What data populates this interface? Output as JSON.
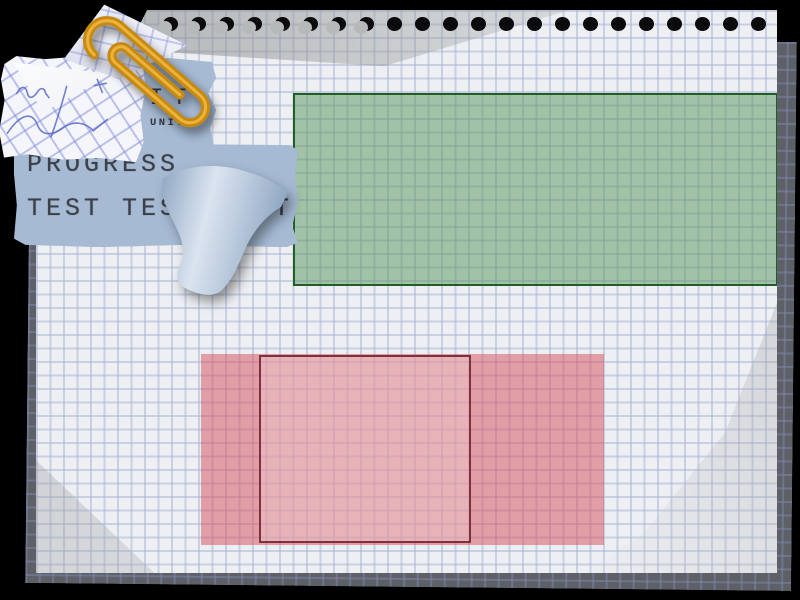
{
  "notebook": {
    "binding_hole_count": 22,
    "torn_hole_count": 8
  },
  "stickers": {
    "unit_label_large": "UNIT A",
    "unit_label_small": "UNIT A",
    "progress_line": "PROGRESS",
    "test_line": "TEST TEST TEST"
  },
  "panels": {
    "green": {
      "fill": "#a4c9a6",
      "border": "#215e26"
    },
    "pink_outer": {
      "fill": "#e2a0a6"
    },
    "pink_inner": {
      "fill": "#e9b4b8",
      "border": "#7e313a"
    }
  },
  "colors": {
    "background": "#000000",
    "page": "#edeff2",
    "page_grid": "#b6bed6",
    "back_page": "#5d6067",
    "green_border": "#215e26",
    "pink_border": "#7e313a",
    "sticky_paper": "#a6bad4",
    "sticky_text": "#2e2f35",
    "note_paper": "#f5f6fb",
    "note_grid": "#8a92dc",
    "handwriting_ink": "#5a6ac2",
    "paperclip_gold": "#c68a12",
    "paperclip_highlight": "#ecb23a"
  }
}
